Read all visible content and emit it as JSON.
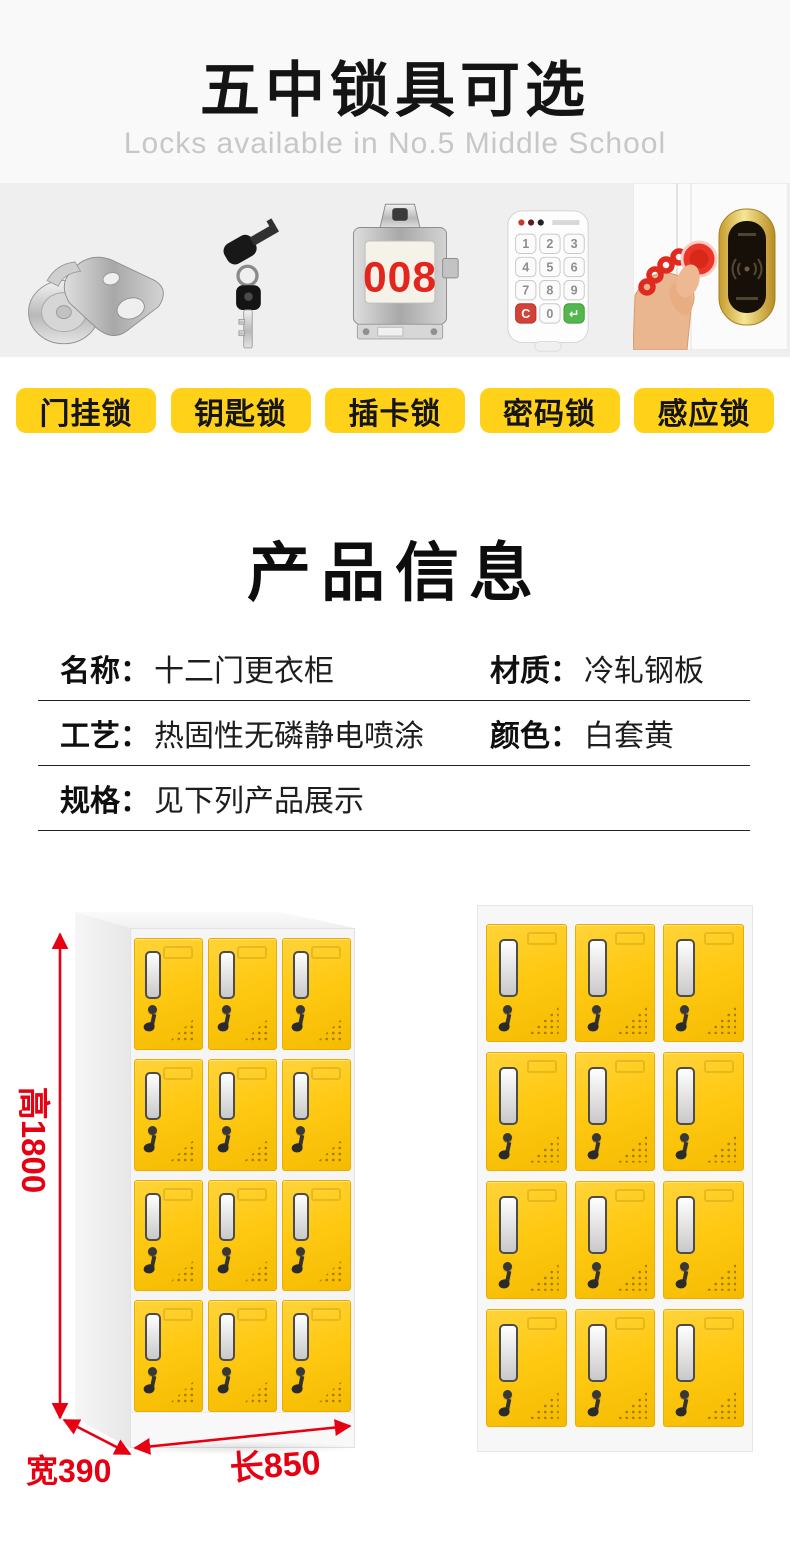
{
  "colors": {
    "accent_yellow": "#ffd118",
    "door_yellow": "#ffc913",
    "dimension_red": "#e60012",
    "title_black": "#141414",
    "subtitle_gray": "#c7c7c7",
    "header_bg": "#f9f9f9",
    "strip_bg": "#efefef",
    "card_digit_red": "#e3261d"
  },
  "header": {
    "title": "五中锁具可选",
    "subtitle": "Locks available in No.5 Middle School"
  },
  "lock_types": {
    "items": [
      {
        "label": "门挂锁",
        "icon": "cam-lock"
      },
      {
        "label": "钥匙锁",
        "icon": "key-lock"
      },
      {
        "label": "插卡锁",
        "icon": "card-lock",
        "card_number": "008"
      },
      {
        "label": "密码锁",
        "icon": "keypad-lock",
        "keys": [
          "1",
          "2",
          "3",
          "4",
          "5",
          "6",
          "7",
          "8",
          "9",
          "C",
          "0",
          "↵"
        ]
      },
      {
        "label": "感应锁",
        "icon": "rfid-lock"
      }
    ]
  },
  "product_info": {
    "title": "产品信息",
    "specs": [
      {
        "label": "名称：",
        "value": "十二门更衣柜"
      },
      {
        "label": "材质：",
        "value": "冷轧钢板"
      },
      {
        "label": "工艺：",
        "value": "热固性无磷静电喷涂"
      },
      {
        "label": "颜色：",
        "value": "白套黄"
      },
      {
        "label": "规格：",
        "value": "见下列产品展示"
      }
    ]
  },
  "dimensions": {
    "height": "高1800",
    "width": "宽390",
    "length": "长850"
  },
  "lockers": {
    "rows": 4,
    "cols": 3
  }
}
